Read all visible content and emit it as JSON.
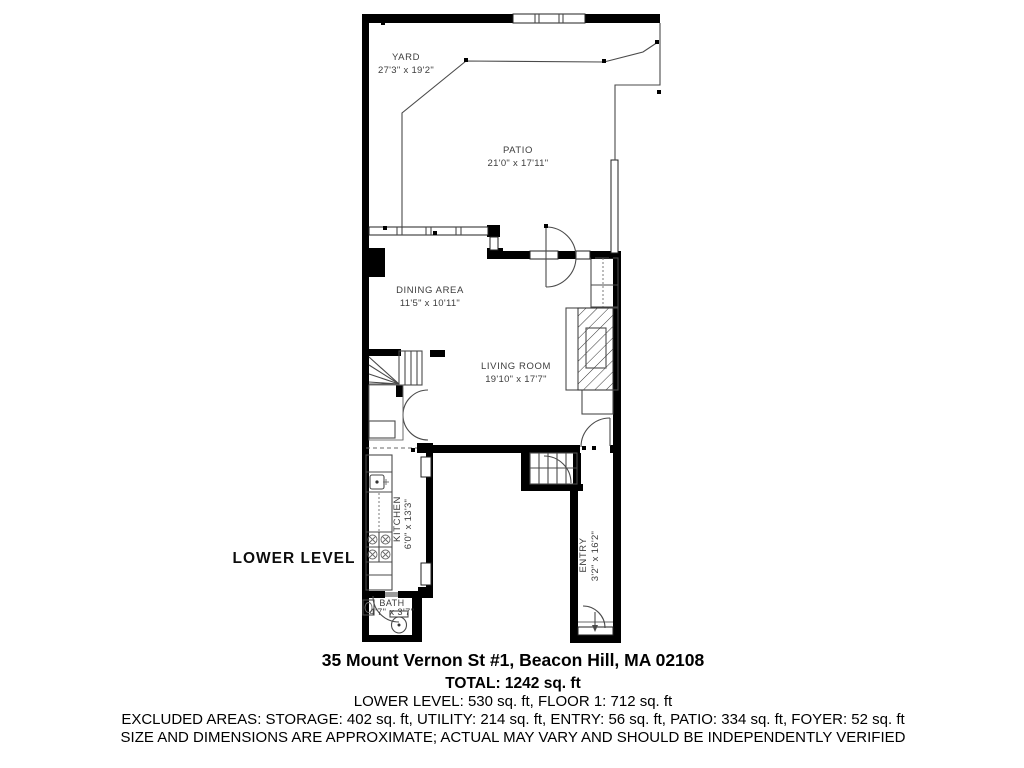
{
  "plan_label": "LOWER LEVEL",
  "rooms": {
    "yard": {
      "name": "YARD",
      "dims": "27'3\" x 19'2\""
    },
    "patio": {
      "name": "PATIO",
      "dims": "21'0\" x 17'11\""
    },
    "dining": {
      "name": "DINING AREA",
      "dims": "11'5\" x 10'11\""
    },
    "living": {
      "name": "LIVING ROOM",
      "dims": "19'10\" x 17'7\""
    },
    "kitchen": {
      "name": "KITCHEN",
      "dims": "6'0\" x 13'3\""
    },
    "entry": {
      "name": "ENTRY",
      "dims": "3'2\" x 16'2\""
    },
    "bath": {
      "name": "BATH",
      "dims": "4'7\" x 3'7\""
    }
  },
  "footer": {
    "address": "35 Mount Vernon St #1, Beacon Hill, MA 02108",
    "total": "TOTAL: 1242 sq. ft",
    "levels": "LOWER LEVEL: 530 sq. ft, FLOOR 1: 712 sq. ft",
    "excluded": "EXCLUDED AREAS: STORAGE: 402 sq. ft, UTILITY: 214 sq. ft, ENTRY: 56 sq. ft, PATIO: 334 sq. ft, FOYER: 52 sq. ft",
    "disclaimer": "SIZE AND DIMENSIONS ARE APPROXIMATE; ACTUAL MAY VARY AND SHOULD BE INDEPENDENTLY VERIFIED"
  },
  "colors": {
    "wall": "#000000",
    "line": "#4a4a4a",
    "label": "#3d3d3d"
  }
}
